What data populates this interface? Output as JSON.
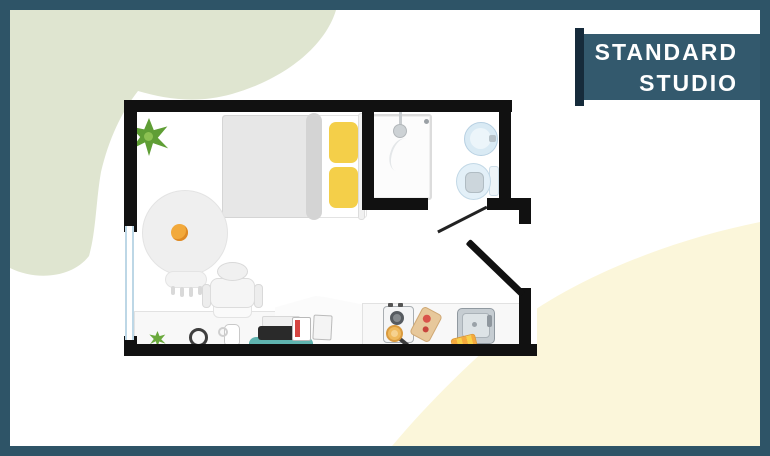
{
  "banner": {
    "line1": "STANDARD",
    "line2": "STUDIO"
  },
  "colors": {
    "frame_teal": "#2e5467",
    "banner_teal": "#33596d",
    "banner_shadow_navy": "#162b3b",
    "wall_black": "#111111",
    "blob_green": "#dfe5d0",
    "blob_yellow": "#fbf6da",
    "pillow_yellow": "#f4cf49",
    "desk_mat_teal": "#5fb3af",
    "window_blue": "#bdd7e6"
  },
  "floorplan": {
    "icons": [
      "plant-icon",
      "double-bed-icon",
      "pillow-icon",
      "round-chair-icon",
      "desk-chair-icon",
      "desk-counter-icon",
      "laptop-icon",
      "headphones-icon",
      "mug-icon",
      "books-icon",
      "mini-plant-icon",
      "stove-icon",
      "frying-pan-icon",
      "cutting-board-icon",
      "kitchen-sink-icon",
      "towel-icon",
      "shower-icon",
      "washbasin-icon",
      "toilet-icon",
      "window-icon",
      "entrance-door-icon",
      "bathroom-door-icon"
    ]
  }
}
